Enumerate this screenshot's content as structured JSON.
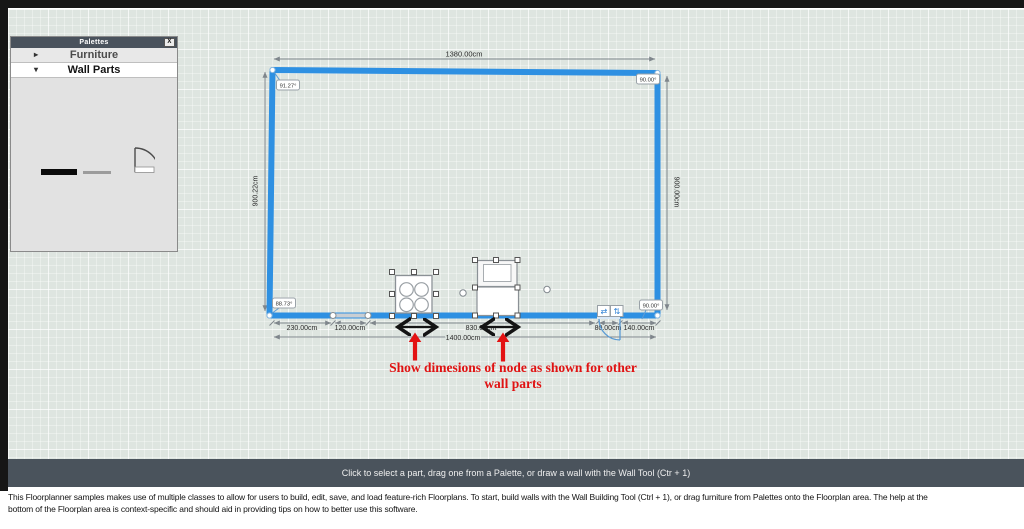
{
  "palette": {
    "title": "Palettes",
    "close_icon": "X",
    "sections": [
      {
        "label": "Furniture",
        "arrow_icon": "▸",
        "state": "collapsed"
      },
      {
        "label": "Wall Parts",
        "arrow_icon": "▾",
        "state": "expanded"
      }
    ]
  },
  "floorplan": {
    "dim_top": "1380.00cm",
    "dim_left": "900.22cm",
    "dim_right": "900.00cm",
    "dim_total": "1400.00cm",
    "dim_segments": [
      "230.00cm",
      "120.00cm",
      "830.00cm",
      "80.00cm",
      "140.00cm"
    ],
    "angle_top_left": "91.27°",
    "angle_top_right": "90.00°",
    "angle_bottom_left": "88.73°",
    "angle_bottom_right": "90.00°",
    "door_flip_h_icon": "⇄",
    "door_flip_v_icon": "⇅"
  },
  "annotation": {
    "text": "Show dimesions of node as shown for other wall parts"
  },
  "status_bar": {
    "message": "Click to select a part, drag one from a Palette, or draw a wall with the Wall Tool (Ctr + 1)"
  },
  "footer": {
    "line1": "This Floorplanner samples makes use of multiple classes to allow for users to build, edit, save, and load feature-rich Floorplans. To start, build walls with the Wall Building Tool (Ctrl + 1), or drag furniture from Palettes onto the Floorplan area. The help at the",
    "line2": "bottom of the Floorplan area is context-specific and should aid in providing tips on how to better use this software."
  },
  "colors": {
    "wall_blue": "#2e90e2",
    "annotation_red": "#e01212",
    "status_bar_bg": "#4a535c",
    "grid_bg": "#dee5e0"
  }
}
